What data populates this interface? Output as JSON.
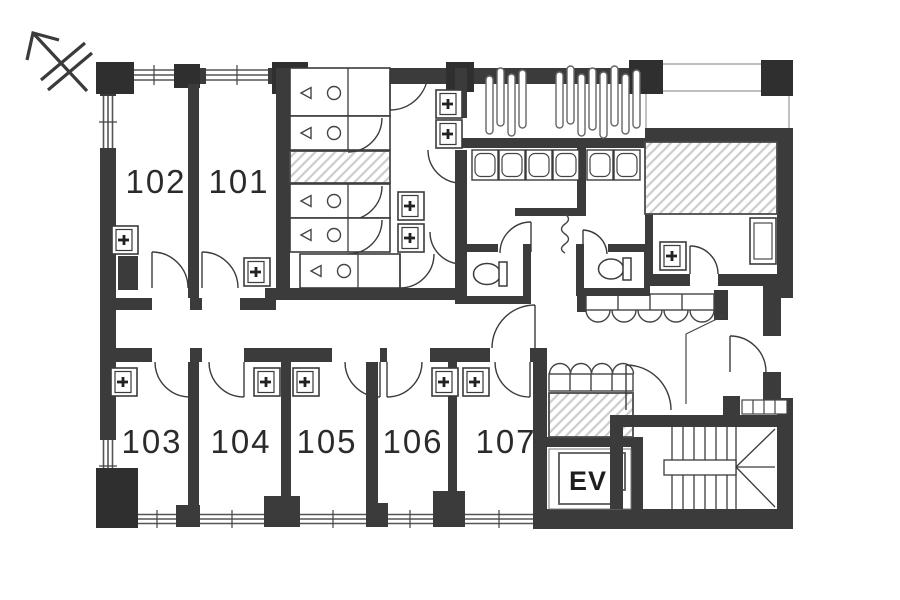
{
  "title": "apartment-first-floor-plan",
  "colors": {
    "wall": "#3b3b3b",
    "column": "#2f2f2f",
    "line": "#444444",
    "hatch_line": "#cccccc",
    "text": "#2b2b2b",
    "background": "#ffffff"
  },
  "rooms": {
    "upper": [
      {
        "label": "102"
      },
      {
        "label": "101"
      }
    ],
    "lower": [
      {
        "label": "103"
      },
      {
        "label": "104"
      },
      {
        "label": "105"
      },
      {
        "label": "106"
      },
      {
        "label": "107"
      }
    ],
    "elevator": {
      "label": "EV"
    }
  },
  "fixtures": {
    "north_arrow": "north-arrow-icon",
    "unit_bathrooms": 5,
    "washer_boxes": 12,
    "kitchen_stations": 6,
    "counter_seats_upper": 5,
    "counter_seats_lower": 4,
    "toilets": 2,
    "plant_capsules": 12,
    "staircase": "u-shaped-staircase",
    "hatched_shafts": 3
  }
}
